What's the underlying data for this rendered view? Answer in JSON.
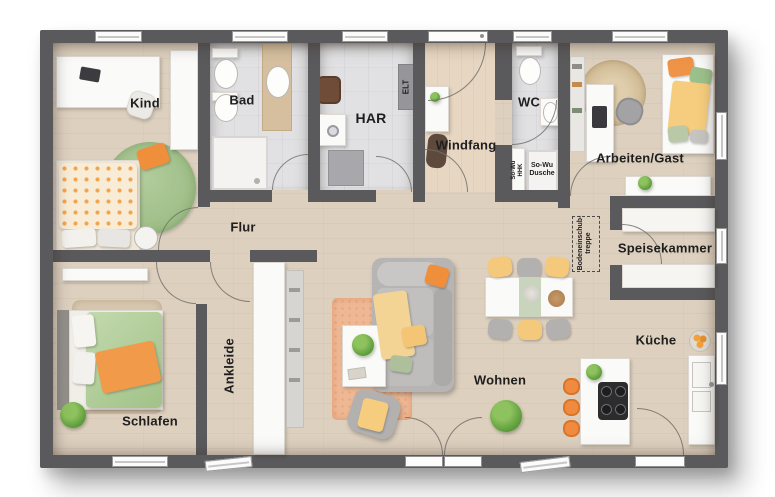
{
  "floorplan": {
    "rooms": [
      {
        "id": "kind",
        "label": "Kind"
      },
      {
        "id": "bad",
        "label": "Bad"
      },
      {
        "id": "har",
        "label": "HAR"
      },
      {
        "id": "windfang",
        "label": "Windfang"
      },
      {
        "id": "wc",
        "label": "WC"
      },
      {
        "id": "arbeiten_gast",
        "label": "Arbeiten/Gast"
      },
      {
        "id": "flur",
        "label": "Flur"
      },
      {
        "id": "speisekammer",
        "label": "Speisekammer"
      },
      {
        "id": "schlafen",
        "label": "Schlafen"
      },
      {
        "id": "ankleide",
        "label": "Ankleide"
      },
      {
        "id": "wohnen",
        "label": "Wohnen"
      },
      {
        "id": "kueche",
        "label": "Küche"
      }
    ],
    "annotations": {
      "elt": "ELT",
      "so_wu_dusche": "So-Wu\nDusche",
      "so_wu_hhk": "So-Wu\nHHK",
      "bodeneinschubtreppe": "Bodeneinschub-\ntreppe"
    },
    "colors": {
      "wall": "#5a595b",
      "floor_wood": "#ddd0bf",
      "floor_entry_wood": "#e7d6c1",
      "floor_tile": "#e1e1e3",
      "accent_orange": "#f0923e",
      "accent_yellow": "#f6c877",
      "accent_green": "#a6c491",
      "rug_salmon": "#efb894",
      "furniture_white": "#fafaf8",
      "background": "#ffffff"
    }
  }
}
